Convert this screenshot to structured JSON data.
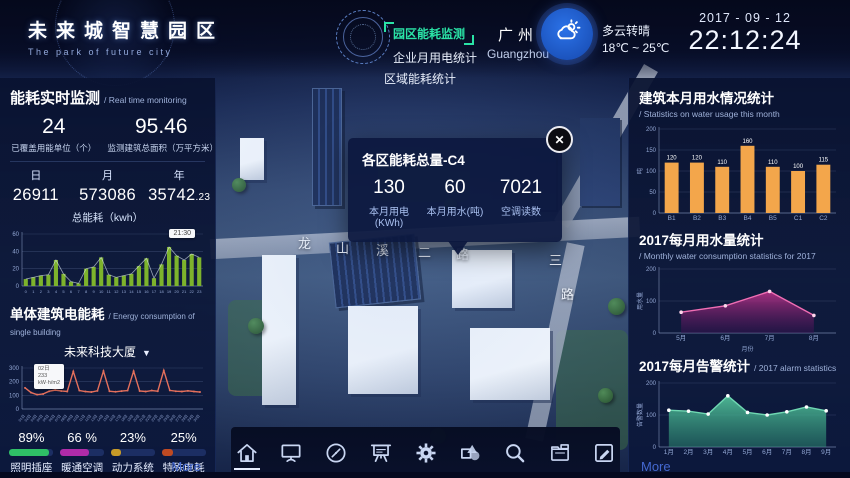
{
  "header": {
    "logo": {
      "title": "未来城智慧园区",
      "subtitle": "The park of future city"
    },
    "nav": {
      "items": [
        {
          "label": "园区能耗监测",
          "active": true
        },
        {
          "label": "企业月用电统计",
          "active": false
        },
        {
          "label": "区域能耗统计",
          "active": false
        }
      ]
    },
    "city": {
      "name": "广州",
      "name_en": "Guangzhou"
    },
    "weather": {
      "icon": "sun-cloud-icon",
      "condition": "多云转晴",
      "temp_range": "18℃ ~ 25℃"
    },
    "datetime": {
      "date": "2017 - 09 - 12",
      "time": "22:12:24"
    }
  },
  "left_panel": {
    "title": "能耗实时监测",
    "title_en": "/ Real time monitoring",
    "stats": [
      {
        "value": "24",
        "label": "已覆盖用能单位（个）"
      },
      {
        "value": "95.46",
        "label": "监测建筑总面积（万平方米）"
      }
    ],
    "totals": [
      {
        "label": "日",
        "value": "26911",
        "decimal": ""
      },
      {
        "label": "月",
        "value": "573086",
        "decimal": ""
      },
      {
        "label": "年",
        "value": "35742",
        "decimal": ".23"
      }
    ],
    "totals_caption": "总能耗（kwh）",
    "building": {
      "title": "单体建筑电能耗",
      "title_en": "/ Energy consumption of single building",
      "selector": "未来科技大厦",
      "caret": "▼"
    },
    "usage_breakdown": [
      {
        "percent": "89%",
        "label": "照明插座",
        "color": "#2fbf66"
      },
      {
        "percent": "66 %",
        "label": "暖通空调",
        "color": "#b02ba8"
      },
      {
        "percent": "23%",
        "label": "动力系统",
        "color": "#c79a27"
      },
      {
        "percent": "25%",
        "label": "特殊电耗",
        "color": "#bf4a22"
      }
    ],
    "more": "More"
  },
  "right_panel": {
    "sections": [
      {
        "title": "建筑本月用水情况统计",
        "title_en": "/ Statistics on water usage this month"
      },
      {
        "title": "2017每月用水量统计",
        "title_en": "/ Monthly water consumption statistics for 2017"
      },
      {
        "title": "2017每月告警统计",
        "title_en": "/ 2017 alarm statistics"
      }
    ],
    "more": "More"
  },
  "popup": {
    "title": "各区能耗总量-C4",
    "close_icon": "✕",
    "stats": [
      {
        "value": "130",
        "label": "本月用电(KWh)"
      },
      {
        "value": "60",
        "label": "本月用水(吨)"
      },
      {
        "value": "7021",
        "label": "空调读数"
      }
    ]
  },
  "map": {
    "road_labels": [
      "龙",
      "山",
      "溪",
      "二",
      "路"
    ],
    "road_labels_vertical": [
      "三",
      "路"
    ]
  },
  "toolbar": {
    "active_index": 0,
    "icons": [
      "home-icon",
      "monitor-icon",
      "compass-icon",
      "presentation-icon",
      "settings-icon",
      "shapes-icon",
      "search-icon",
      "files-icon",
      "edit-icon"
    ]
  },
  "chart_data": [
    {
      "id": "hourly-energy",
      "type": "bar",
      "title": "总能耗（kwh）",
      "xlabel": "",
      "ylabel": "",
      "categories": [
        "0",
        "1",
        "2",
        "3",
        "4",
        "5",
        "6",
        "7",
        "8",
        "9",
        "10",
        "11",
        "12",
        "13",
        "14",
        "15",
        "16",
        "17",
        "18",
        "19",
        "20",
        "21",
        "22",
        "23"
      ],
      "values": [
        8,
        10,
        12,
        13,
        30,
        14,
        5,
        3,
        20,
        22,
        33,
        13,
        10,
        12,
        14,
        23,
        32,
        9,
        25,
        45,
        35,
        30,
        37,
        33
      ],
      "ylim": [
        0,
        60
      ],
      "yticks": [
        0,
        20,
        40,
        60
      ],
      "bar_color": "#7db32c",
      "line_overlay": true,
      "line_color": "#dfe9f5",
      "grid": true,
      "tooltip": "21:30"
    },
    {
      "id": "building-energy",
      "type": "line",
      "title": "未来科技大厦",
      "xlabel": "",
      "ylabel": "",
      "categories": [
        "01日",
        "02日",
        "03日",
        "04日",
        "05日",
        "06日",
        "07日",
        "08日",
        "09日",
        "10日",
        "11日",
        "12日",
        "13日",
        "14日",
        "15日",
        "16日",
        "17日",
        "18日",
        "19日",
        "20日",
        "21日",
        "22日",
        "23日",
        "24日",
        "25日",
        "26日",
        "27日",
        "28日",
        "29日",
        "30日"
      ],
      "values": [
        155,
        120,
        105,
        110,
        130,
        138,
        132,
        128,
        275,
        135,
        128,
        124,
        133,
        278,
        130,
        126,
        131,
        135,
        277,
        132,
        128,
        135,
        130,
        282,
        136,
        130,
        128,
        133,
        128,
        124
      ],
      "ylim": [
        0,
        300
      ],
      "yticks": [
        0,
        100,
        200,
        300
      ],
      "line_color": "#e4705c",
      "marker_color": "#e4705c",
      "rotate_labels": true,
      "grid": true,
      "tooltip_lines": [
        "02日",
        "233",
        "kW·h/m2"
      ]
    },
    {
      "id": "water-month",
      "type": "bar",
      "title": "建筑本月用水情况统计",
      "xlabel": "",
      "ylabel": "吨",
      "categories": [
        "B1",
        "B2",
        "B3",
        "B4",
        "B5",
        "C1",
        "C2"
      ],
      "values": [
        120,
        120,
        110,
        160,
        110,
        100,
        115
      ],
      "ylim": [
        0,
        200
      ],
      "yticks": [
        0,
        50,
        100,
        150,
        200
      ],
      "bar_color": "#f3a64b",
      "show_values": true,
      "grid": true
    },
    {
      "id": "water-2017",
      "type": "area",
      "title": "2017每月用水量统计",
      "xlabel": "月份",
      "ylabel": "用水量",
      "categories": [
        "5月",
        "6月",
        "7月",
        "8月"
      ],
      "values": [
        65,
        85,
        130,
        55
      ],
      "ylim": [
        0,
        200
      ],
      "yticks": [
        0,
        100,
        200
      ],
      "line_color": "#f06eb4",
      "fill_top": "#c2348c",
      "fill_bottom": "#3a1050",
      "marker_color": "#ffd6ec",
      "fill_opacity": 0.85,
      "grid": true
    },
    {
      "id": "alarm-2017",
      "type": "area",
      "title": "2017每月告警统计",
      "xlabel": "",
      "ylabel": "告警数量",
      "categories": [
        "1月",
        "2月",
        "3月",
        "4月",
        "5月",
        "6月",
        "7月",
        "8月",
        "9月"
      ],
      "values": [
        115,
        112,
        103,
        160,
        108,
        100,
        110,
        125,
        113
      ],
      "ylim": [
        0,
        200
      ],
      "yticks": [
        0,
        100,
        200
      ],
      "line_color": "#6fd8b2",
      "fill_top": "#53c29b",
      "fill_bottom": "#2e8f74",
      "marker_color": "#ffffff",
      "fill_opacity": 0.92,
      "grid": true
    }
  ]
}
